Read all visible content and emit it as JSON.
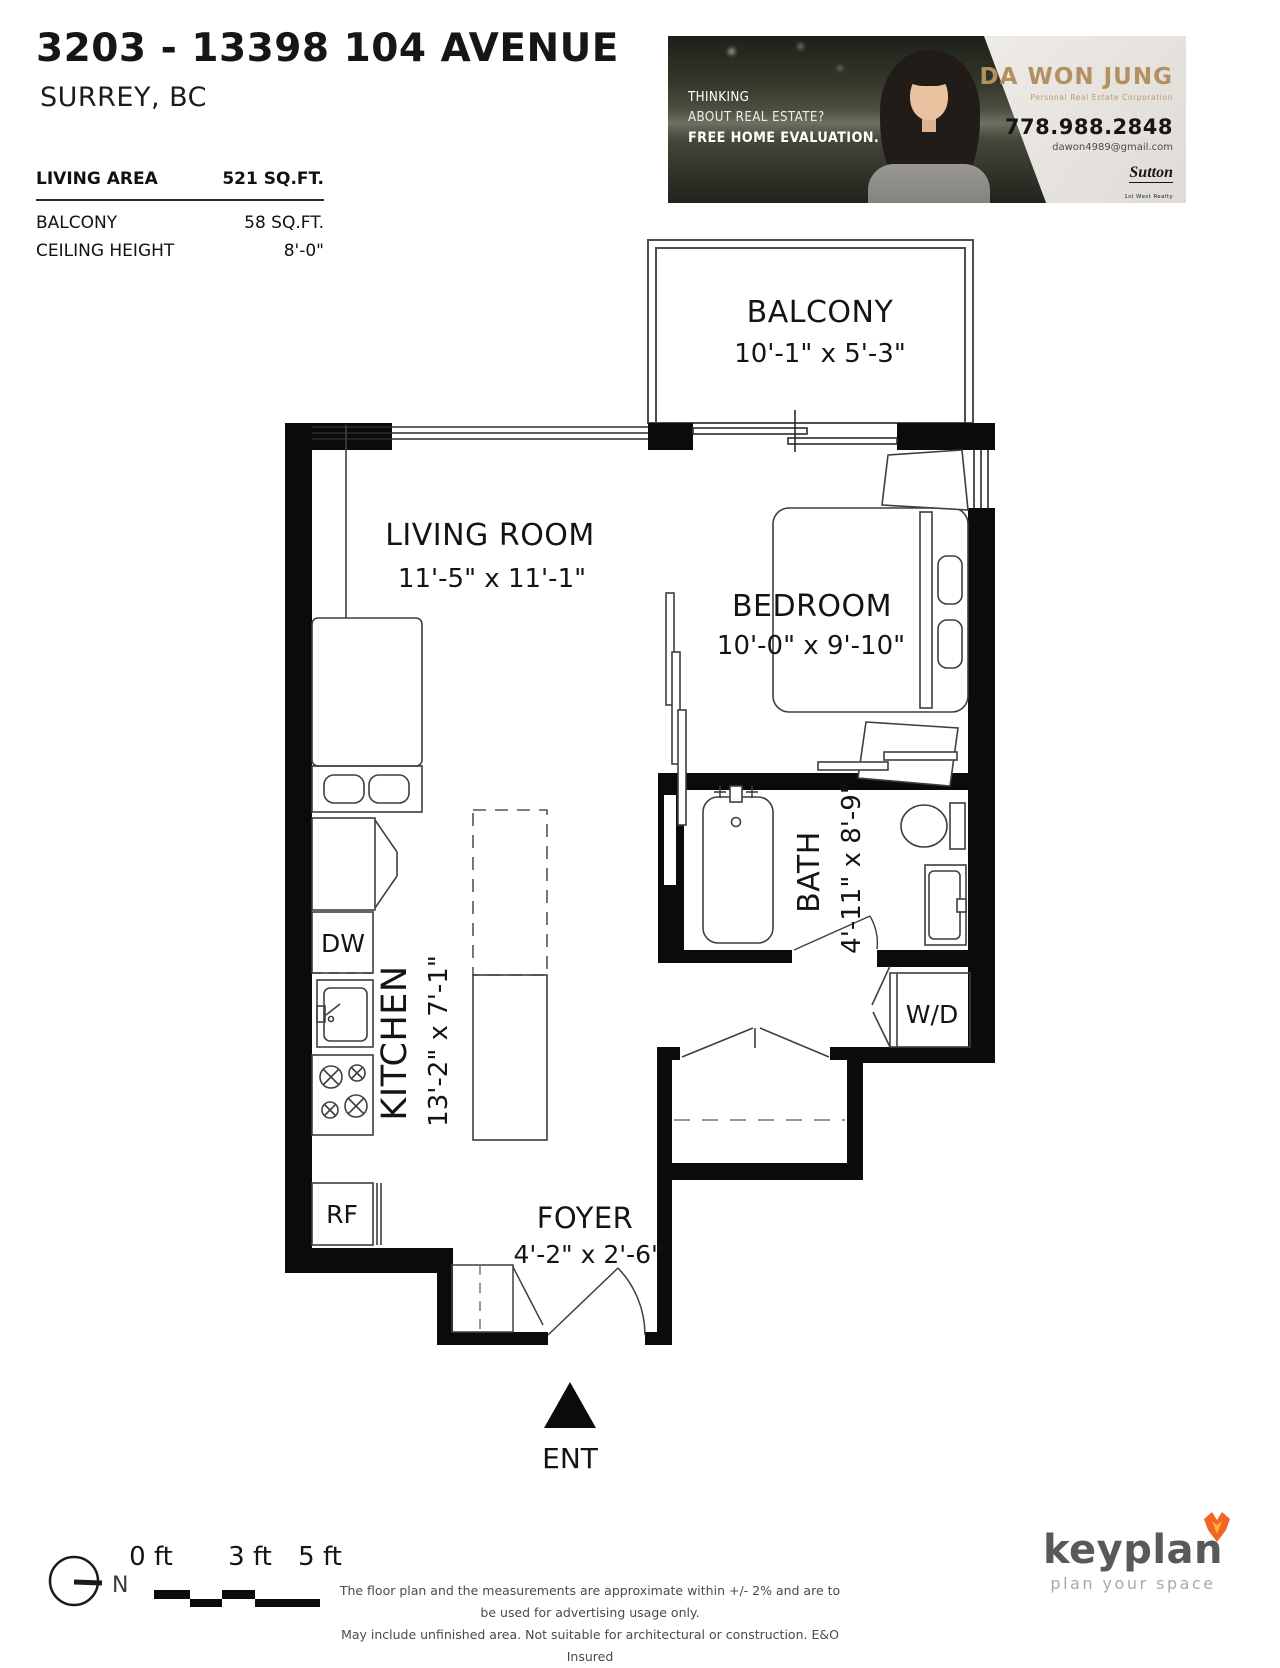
{
  "header": {
    "title": "3203 - 13398 104 AVENUE",
    "subtitle": "SURREY, BC",
    "stats": [
      {
        "label": "LIVING AREA",
        "value": "521 SQ.FT."
      },
      {
        "label": "BALCONY",
        "value": "58 SQ.FT."
      },
      {
        "label": "CEILING HEIGHT",
        "value": "8'-0\""
      }
    ]
  },
  "banner": {
    "tagline": [
      "THINKING",
      "ABOUT REAL ESTATE?",
      "FREE HOME EVALUATION."
    ],
    "agent_name": "DA WON JUNG",
    "agent_title": "Personal Real Estate Corporation",
    "phone": "778.988.2848",
    "email": "dawon4989@gmail.com",
    "brokerage": "Sutton",
    "brokerage_sub": "1st West Realty",
    "accent_color": "#b3905f"
  },
  "floorplan": {
    "rooms": [
      {
        "name": "BALCONY",
        "dims": "10'-1\" x 5'-3\""
      },
      {
        "name": "LIVING ROOM",
        "dims": "11'-5\" x 11'-1\""
      },
      {
        "name": "BEDROOM",
        "dims": "10'-0\" x 9'-10\""
      },
      {
        "name": "BATH",
        "dims": "4'-11\" x 8'-9\""
      },
      {
        "name": "KITCHEN",
        "dims": "13'-2\" x 7'-1\""
      },
      {
        "name": "FOYER",
        "dims": "4'-2\" x 2'-6\""
      }
    ],
    "appliances": {
      "dishwasher": "DW",
      "fridge": "RF",
      "washer_dryer": "W/D"
    },
    "entry_label": "ENT"
  },
  "footer": {
    "scale_ticks": [
      "0 ft",
      "3 ft",
      "5 ft"
    ],
    "north_label": "N",
    "disclaimer_line1": "The floor plan and the measurements are approximate within +/- 2% and are to be used for advertising usage only.",
    "disclaimer_line2": "May include unfinished area. Not suitable for architectural or construction. E&O Insured",
    "logo_text": "keyplan",
    "logo_tagline": "plan your space",
    "logo_color": "#58595b",
    "logo_accent": "#f26522"
  }
}
